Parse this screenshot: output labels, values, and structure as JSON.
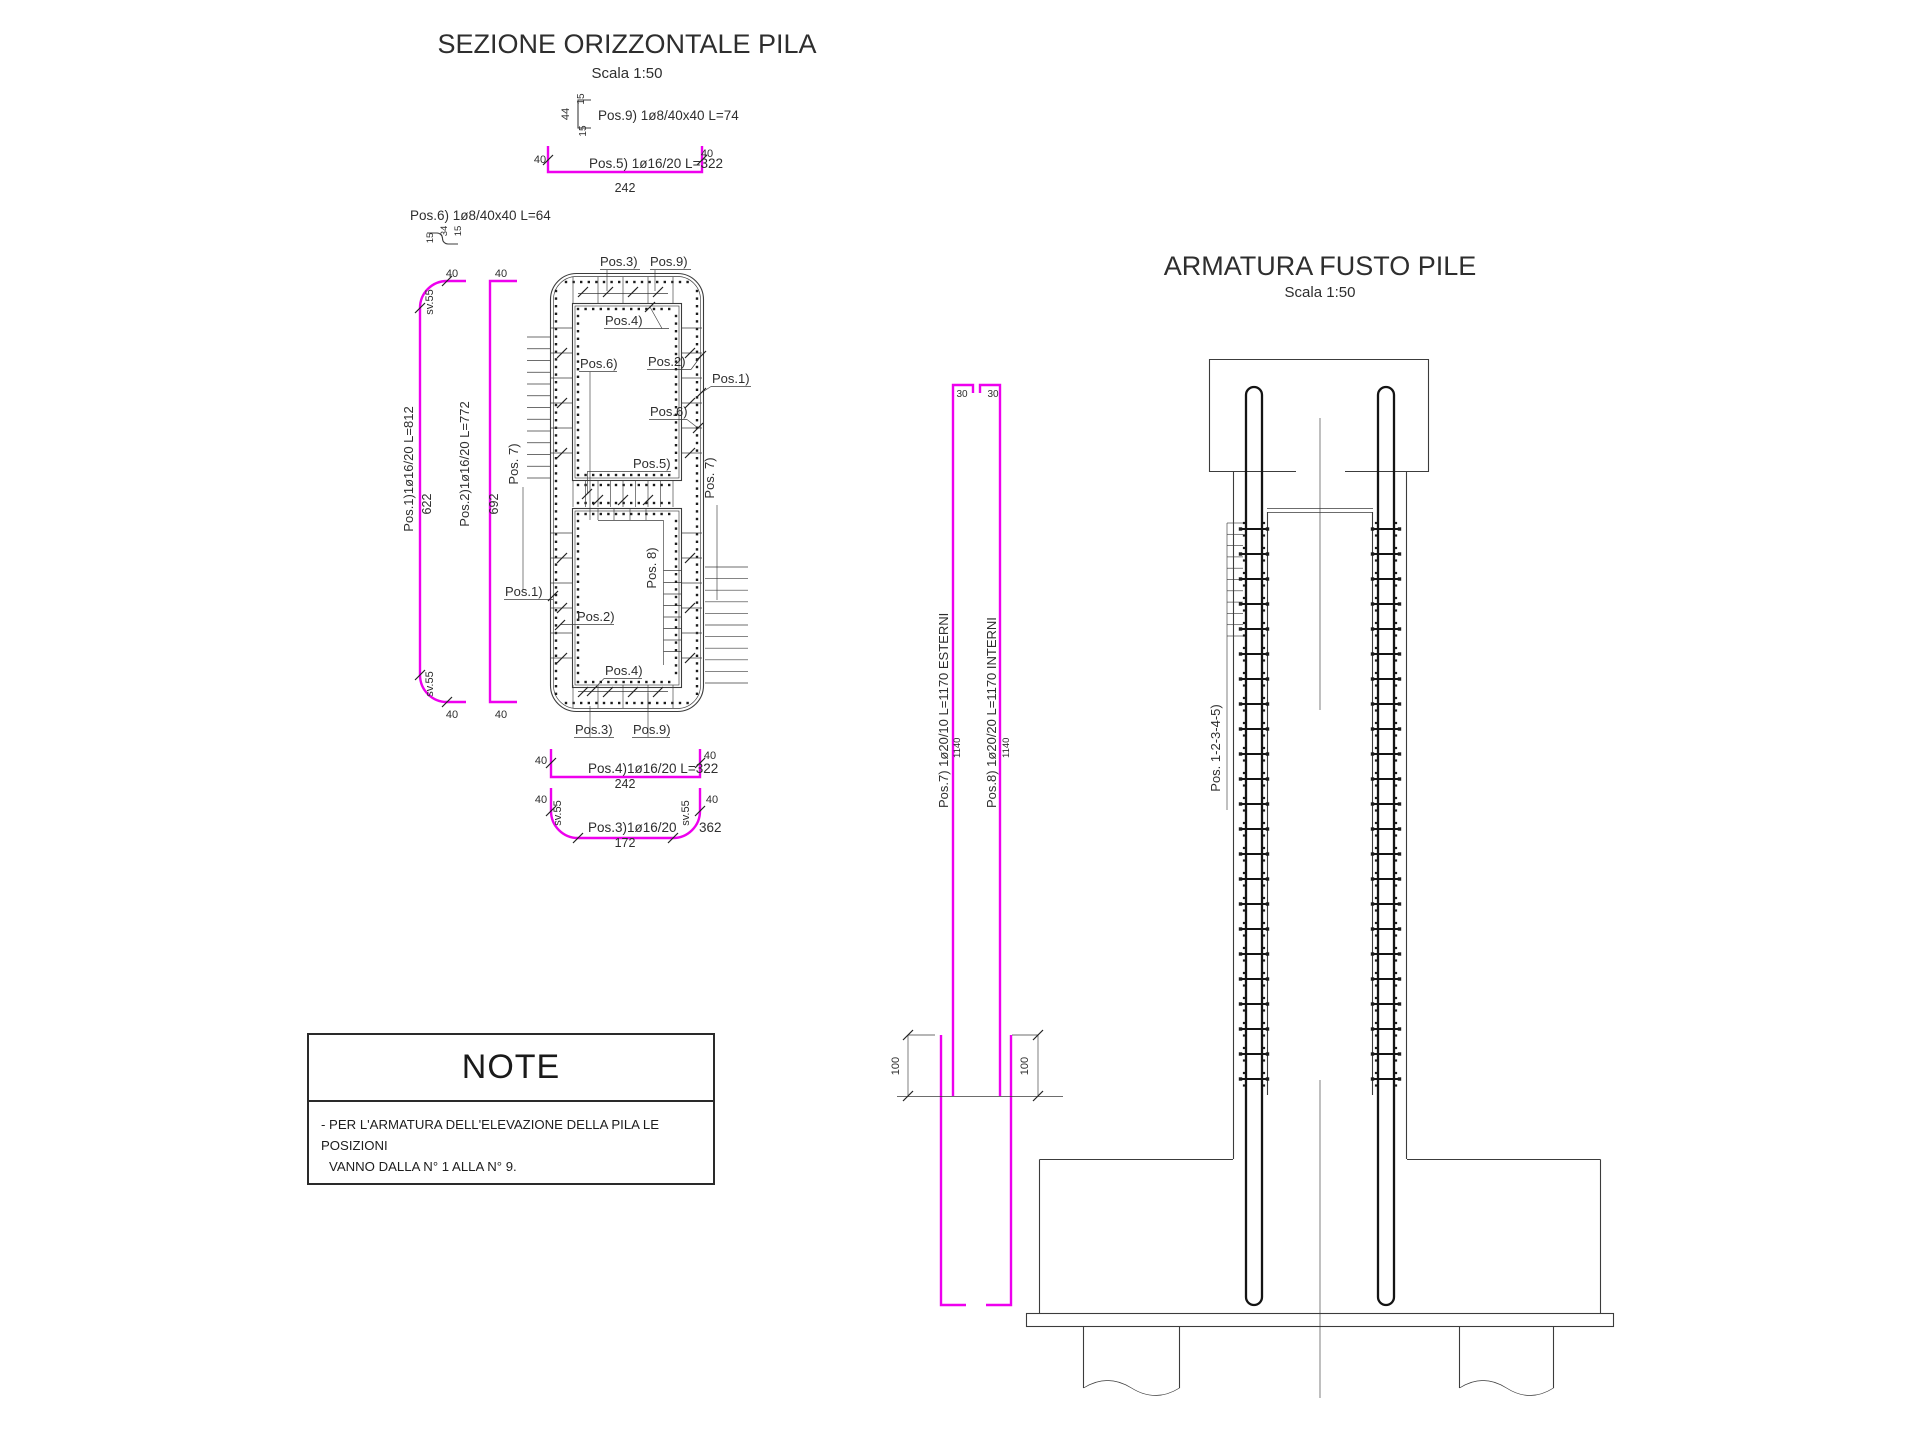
{
  "colors": {
    "magenta": "#ee00ee",
    "line": "#3c3c3c",
    "rebar": "#141414",
    "text": "#2e2e2e"
  },
  "note": {
    "title": "NOTE",
    "line1": "- PER L'ARMATURA DELL'ELEVAZIONE DELLA PILA LE POSIZIONI",
    "line2": "VANNO DALLA N° 1 ALLA N° 9."
  },
  "labels": [
    {
      "name": "section-title",
      "text": "SEZIONE ORIZZONTALE PILA",
      "x": 627,
      "y": 53,
      "size": 27,
      "rot": 0,
      "anchor": "middle"
    },
    {
      "name": "section-scale",
      "text": "Scala 1:50",
      "x": 627,
      "y": 78,
      "size": 15,
      "rot": 0,
      "anchor": "middle"
    },
    {
      "name": "elevation-title",
      "text": "ARMATURA FUSTO PILE",
      "x": 1320,
      "y": 275,
      "size": 27,
      "rot": 0,
      "anchor": "middle"
    },
    {
      "name": "elevation-scale",
      "text": "Scala 1:50",
      "x": 1320,
      "y": 297,
      "size": 15,
      "rot": 0,
      "anchor": "middle"
    },
    {
      "name": "dim-44",
      "text": "44",
      "x": 569,
      "y": 114,
      "size": 11,
      "rot": -90,
      "anchor": "middle"
    },
    {
      "name": "dim-15-top",
      "text": "15",
      "x": 584,
      "y": 99,
      "size": 10,
      "rot": -90,
      "anchor": "middle"
    },
    {
      "name": "dim-15-bot",
      "text": "15",
      "x": 586,
      "y": 131,
      "size": 10,
      "rot": -90,
      "anchor": "middle"
    },
    {
      "name": "pos9-schedule",
      "text": "Pos.9) 1ø8/40x40 L=74",
      "x": 598,
      "y": 120,
      "size": 13.5,
      "rot": 0,
      "anchor": "start"
    },
    {
      "name": "dim-40-pos5-left",
      "text": "40",
      "x": 540,
      "y": 163,
      "size": 11,
      "rot": 0,
      "anchor": "middle"
    },
    {
      "name": "pos5-schedule",
      "text": "Pos.5) 1ø16/20 L=322",
      "x": 589,
      "y": 168,
      "size": 13.5,
      "rot": 0,
      "anchor": "start"
    },
    {
      "name": "dim-40-pos5-right",
      "text": "40",
      "x": 707,
      "y": 157,
      "size": 11,
      "rot": 0,
      "anchor": "middle"
    },
    {
      "name": "dim-242-pos5",
      "text": "242",
      "x": 625,
      "y": 192,
      "size": 12.5,
      "rot": 0,
      "anchor": "middle"
    },
    {
      "name": "pos6-schedule",
      "text": "Pos.6) 1ø8/40x40 L=64",
      "x": 410,
      "y": 220,
      "size": 13.5,
      "rot": 0,
      "anchor": "start"
    },
    {
      "name": "dim-15a-pos6",
      "text": "15",
      "x": 433,
      "y": 238,
      "size": 9.5,
      "rot": -90,
      "anchor": "middle"
    },
    {
      "name": "dim-34-pos6",
      "text": "34",
      "x": 447,
      "y": 231,
      "size": 9.5,
      "rot": -90,
      "anchor": "middle"
    },
    {
      "name": "dim-15b-pos6",
      "text": "15",
      "x": 461,
      "y": 231,
      "size": 9.5,
      "rot": -90,
      "anchor": "middle"
    },
    {
      "name": "dim-40-pos1-top",
      "text": "40",
      "x": 452,
      "y": 277,
      "size": 11,
      "rot": 0,
      "anchor": "middle"
    },
    {
      "name": "dim-40-pos2-top",
      "text": "40",
      "x": 501,
      "y": 277,
      "size": 11,
      "rot": 0,
      "anchor": "middle"
    },
    {
      "name": "dim-sv55-pos1-top",
      "text": "sv.55",
      "x": 433,
      "y": 302,
      "size": 11,
      "rot": -90,
      "anchor": "middle"
    },
    {
      "name": "pos1-schedule",
      "text": "Pos.1)1ø16/20  L=812",
      "x": 413,
      "y": 469,
      "size": 13,
      "rot": -90,
      "anchor": "middle"
    },
    {
      "name": "dim-622-pos1",
      "text": "622",
      "x": 431,
      "y": 504,
      "size": 12.5,
      "rot": -90,
      "anchor": "middle"
    },
    {
      "name": "pos2-schedule",
      "text": "Pos.2)1ø16/20  L=772",
      "x": 469,
      "y": 464,
      "size": 13,
      "rot": -90,
      "anchor": "middle"
    },
    {
      "name": "dim-692-pos2",
      "text": "692",
      "x": 498,
      "y": 504,
      "size": 12.5,
      "rot": -90,
      "anchor": "middle"
    },
    {
      "name": "dim-sv55-pos1-bot",
      "text": "sv.55",
      "x": 433,
      "y": 684,
      "size": 11,
      "rot": -90,
      "anchor": "middle"
    },
    {
      "name": "dim-40-pos1-bot",
      "text": "40",
      "x": 452,
      "y": 718,
      "size": 11,
      "rot": 0,
      "anchor": "middle"
    },
    {
      "name": "dim-40-pos2-bot",
      "text": "40",
      "x": 501,
      "y": 718,
      "size": 11,
      "rot": 0,
      "anchor": "middle"
    },
    {
      "name": "label-pos3-top",
      "text": "Pos.3)",
      "x": 600,
      "y": 266,
      "size": 13,
      "rot": 0,
      "anchor": "start"
    },
    {
      "name": "label-pos9-top",
      "text": "Pos.9)",
      "x": 650,
      "y": 266,
      "size": 13,
      "rot": 0,
      "anchor": "start"
    },
    {
      "name": "label-pos4-top",
      "text": "Pos.4)",
      "x": 605,
      "y": 325,
      "size": 13,
      "rot": 0,
      "anchor": "start"
    },
    {
      "name": "label-pos6-upper",
      "text": "Pos.6)",
      "x": 580,
      "y": 368,
      "size": 13,
      "rot": 0,
      "anchor": "start"
    },
    {
      "name": "label-pos2-upper",
      "text": "Pos.2)",
      "x": 648,
      "y": 366,
      "size": 13,
      "rot": 0,
      "anchor": "start"
    },
    {
      "name": "label-pos1-right",
      "text": "Pos.1)",
      "x": 712,
      "y": 383,
      "size": 13,
      "rot": 0,
      "anchor": "start"
    },
    {
      "name": "label-pos6-lower",
      "text": "Pos.6)",
      "x": 650,
      "y": 416,
      "size": 13,
      "rot": 0,
      "anchor": "start"
    },
    {
      "name": "label-pos5-mid",
      "text": "Pos.5)",
      "x": 633,
      "y": 468,
      "size": 13,
      "rot": 0,
      "anchor": "start"
    },
    {
      "name": "label-pos7-left",
      "text": "Pos. 7)",
      "x": 518,
      "y": 464,
      "size": 13,
      "rot": -90,
      "anchor": "middle"
    },
    {
      "name": "label-pos7-right",
      "text": "Pos. 7)",
      "x": 714,
      "y": 478,
      "size": 13,
      "rot": -90,
      "anchor": "middle"
    },
    {
      "name": "label-pos8-inner",
      "text": "Pos. 8)",
      "x": 656,
      "y": 568,
      "size": 13,
      "rot": -90,
      "anchor": "middle"
    },
    {
      "name": "label-pos2-lower",
      "text": "Pos.2)",
      "x": 577,
      "y": 621,
      "size": 13,
      "rot": 0,
      "anchor": "start"
    },
    {
      "name": "label-pos4-bot",
      "text": "Pos.4)",
      "x": 605,
      "y": 675,
      "size": 13,
      "rot": 0,
      "anchor": "start"
    },
    {
      "name": "label-pos1-left",
      "text": "Pos.1)",
      "x": 505,
      "y": 596,
      "size": 13,
      "rot": 0,
      "anchor": "start"
    },
    {
      "name": "label-pos3-bot",
      "text": "Pos.3)",
      "x": 575,
      "y": 734,
      "size": 13,
      "rot": 0,
      "anchor": "start"
    },
    {
      "name": "label-pos9-bot",
      "text": "Pos.9)",
      "x": 633,
      "y": 734,
      "size": 13,
      "rot": 0,
      "anchor": "start"
    },
    {
      "name": "dim-40-pos4b-left",
      "text": "40",
      "x": 541,
      "y": 764,
      "size": 11,
      "rot": 0,
      "anchor": "middle"
    },
    {
      "name": "pos4-schedule",
      "text": "Pos.4)1ø16/20  L=322",
      "x": 588,
      "y": 773,
      "size": 13.5,
      "rot": 0,
      "anchor": "start"
    },
    {
      "name": "dim-40-pos4b-right",
      "text": "40",
      "x": 710,
      "y": 759,
      "size": 11,
      "rot": 0,
      "anchor": "middle"
    },
    {
      "name": "dim-242-pos4",
      "text": "242",
      "x": 625,
      "y": 788,
      "size": 12.5,
      "rot": 0,
      "anchor": "middle"
    },
    {
      "name": "dim-40-pos3b-left",
      "text": "40",
      "x": 541,
      "y": 803,
      "size": 11,
      "rot": 0,
      "anchor": "middle"
    },
    {
      "name": "dim-sv55-pos3-left",
      "text": "sv.55",
      "x": 561,
      "y": 813,
      "size": 11,
      "rot": -90,
      "anchor": "middle"
    },
    {
      "name": "dim-sv55-pos3-right",
      "text": "sv.55",
      "x": 689,
      "y": 813,
      "size": 11,
      "rot": -90,
      "anchor": "middle"
    },
    {
      "name": "dim-40-pos3b-right",
      "text": "40",
      "x": 712,
      "y": 803,
      "size": 11,
      "rot": 0,
      "anchor": "middle"
    },
    {
      "name": "pos3-schedule",
      "text": "Pos.3)1ø16/20",
      "x": 588,
      "y": 832,
      "size": 13.5,
      "rot": 0,
      "anchor": "start"
    },
    {
      "name": "pos3-length",
      "text": "362",
      "x": 699,
      "y": 832,
      "size": 13.5,
      "rot": 0,
      "anchor": "start"
    },
    {
      "name": "dim-172-pos3",
      "text": "172",
      "x": 625,
      "y": 847,
      "size": 12.5,
      "rot": 0,
      "anchor": "middle"
    },
    {
      "name": "dim-30-pos7",
      "text": "30",
      "x": 962,
      "y": 397,
      "size": 10,
      "rot": 0,
      "anchor": "middle"
    },
    {
      "name": "dim-30-pos8",
      "text": "30",
      "x": 993,
      "y": 397,
      "size": 10,
      "rot": 0,
      "anchor": "middle"
    },
    {
      "name": "pos7-schedule",
      "text": "Pos.7) 1ø20/10 L=1170 ESTERNI",
      "x": 948,
      "y": 808,
      "size": 13,
      "rot": -90,
      "anchor": "start"
    },
    {
      "name": "dim-1140-pos7",
      "text": "1140",
      "x": 960,
      "y": 758,
      "size": 9.5,
      "rot": -90,
      "anchor": "start"
    },
    {
      "name": "pos8-schedule",
      "text": "Pos.8) 1ø20/20 L=1170 INTERNI",
      "x": 996,
      "y": 808,
      "size": 13,
      "rot": -90,
      "anchor": "start"
    },
    {
      "name": "dim-1140-pos8",
      "text": "1140",
      "x": 1009,
      "y": 758,
      "size": 9.5,
      "rot": -90,
      "anchor": "start"
    },
    {
      "name": "dim-100-left",
      "text": "100",
      "x": 899,
      "y": 1066,
      "size": 11,
      "rot": -90,
      "anchor": "middle"
    },
    {
      "name": "dim-100-right",
      "text": "100",
      "x": 1028,
      "y": 1066,
      "size": 11,
      "rot": -90,
      "anchor": "middle"
    },
    {
      "name": "label-pos12345",
      "text": "Pos. 1-2-3-4-5)",
      "x": 1220,
      "y": 748,
      "size": 13,
      "rot": -90,
      "anchor": "middle"
    }
  ]
}
